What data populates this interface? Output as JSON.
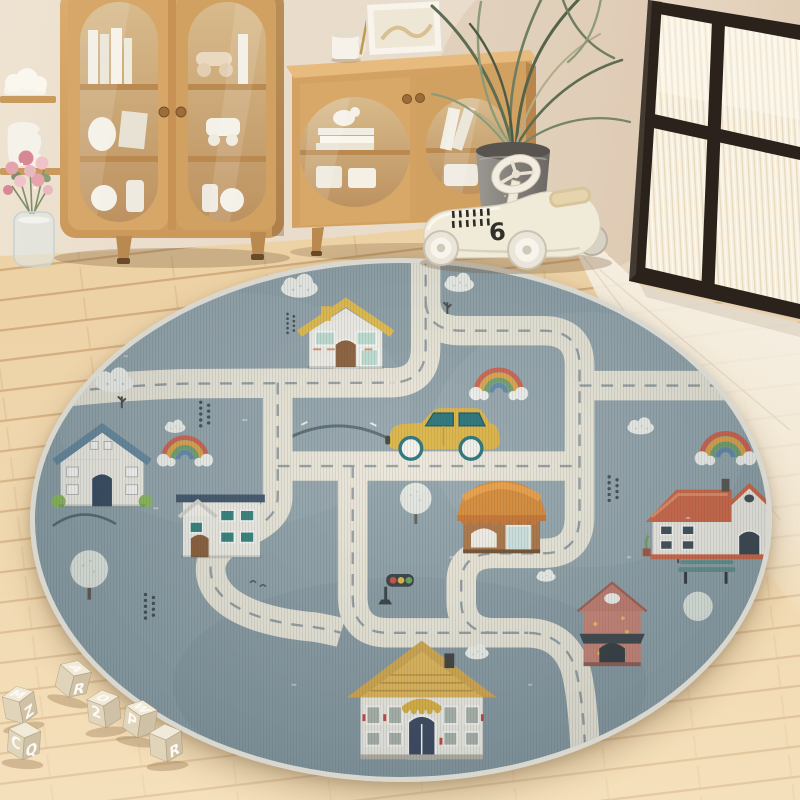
{
  "scene": {
    "setting": "children playroom with round road-map play rug",
    "objects": [
      "tall-bookcase",
      "low-display-cabinet",
      "corner-shelf",
      "flower-bouquet",
      "potted-plant",
      "ride-on-toy-race-car",
      "interior-glass-door",
      "round-play-rug",
      "alphabet-blocks"
    ]
  },
  "toys": {
    "race_car_number": "6",
    "blocks": [
      {
        "top": "M",
        "right": "Z"
      },
      {
        "left": "C",
        "right": "Q"
      },
      {
        "top": "A",
        "right": "R"
      },
      {
        "top": "O",
        "left": "2"
      },
      {
        "top": "W",
        "left": "P"
      },
      {
        "right": "R"
      }
    ]
  },
  "rug": {
    "theme": "town road map",
    "features": [
      "roads with dashed lines",
      "houses",
      "shop with awning",
      "yellow car",
      "traffic light",
      "rainbows",
      "clouds",
      "trees",
      "park bench"
    ]
  },
  "colors": {
    "wall": "#e9dccb",
    "floor_wood": "#edd2a6",
    "floor_light": "#f5efe4",
    "door_frame": "#2a221b",
    "cabinet_wood": "#d5a667",
    "rug_base": "#8d9fa6",
    "rug_border": "#d8d7d0",
    "road": "#ece7d8",
    "road_dash": "#8b969a",
    "car_yellow": "#ddb13c",
    "roof_yellow": "#e6bc45",
    "roof_blue": "#64869c",
    "roof_navy": "#3d5166",
    "roof_red": "#cf6342",
    "roof_mustard": "#d5a748",
    "shop_orange": "#d8872f",
    "house_salmon": "#c98172",
    "bench_teal": "#5f8d89"
  }
}
